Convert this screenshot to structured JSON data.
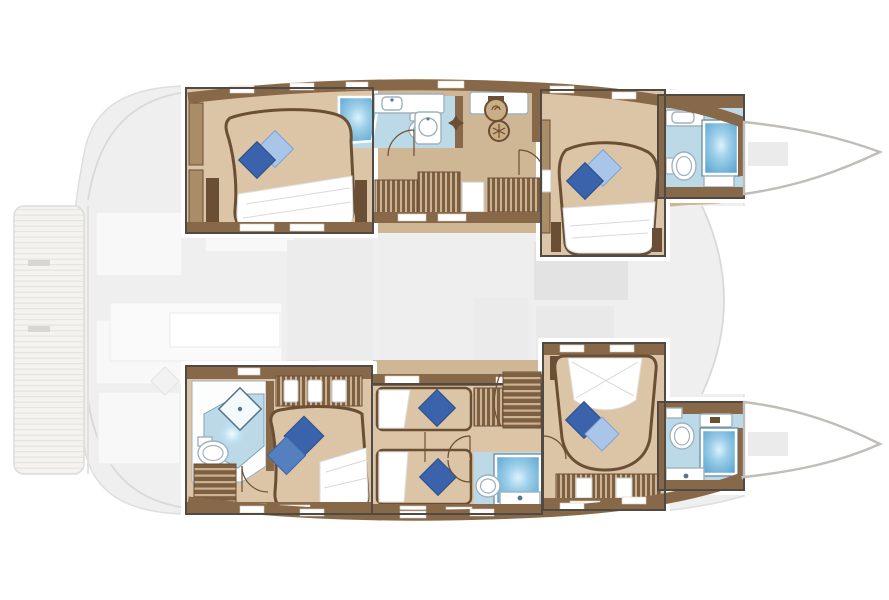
{
  "meta": {
    "aria_label": "Catamaran lower-deck floor plan, bow pointing right",
    "vessel_type": "catamaran",
    "view": "overhead deck / cabin layout plan",
    "bow_direction": "right"
  },
  "palette": {
    "bg": "#ffffff",
    "wood": "#876849",
    "wood_deep": "#6b4f35",
    "wood_mid": "#a98c68",
    "wood_light": "#cbb293",
    "floor": "#cfb694",
    "floor_cabin": "#dbc5a6",
    "bath": "#bcd9e8",
    "shower_deep": "#5da7d2",
    "shower_glow": "#e8f7fe",
    "pillow_navy": "#3a63ac",
    "pillow_blue": "#5580c0",
    "pillow_sky": "#a9c6e8",
    "fixture_stroke": "#9fb2bd",
    "box_border": "#4f4a44",
    "ghost": "#efefef",
    "ghost_2": "#e3e3e3",
    "ghost_stroke": "#d9d9d9",
    "hull_stroke": "#c0bdb8",
    "linen": "#ffffff"
  },
  "layout_counts": {
    "hulls": 2,
    "highlighted_cabin_modules": 6,
    "double_beds": 4,
    "single_beds": 2,
    "bathrooms": 5,
    "showers": 5,
    "stair_flights": 3
  },
  "modules": [
    {
      "id": "aft-port-cabin",
      "features": [
        "double-bed",
        "navy-pillow",
        "sky-pillow",
        "wardrobe",
        "ensuite-shower",
        "toilet",
        "sink"
      ]
    },
    {
      "id": "port-galley-corridor",
      "features": [
        "sink",
        "cooktop-rings",
        "stairs",
        "wardrobes",
        "hull-windows"
      ]
    },
    {
      "id": "fwd-port-cabin",
      "features": [
        "double-bed",
        "navy-pillow",
        "sky-pillow",
        "porthole"
      ]
    },
    {
      "id": "fwd-port-bathroom",
      "features": [
        "shower",
        "toilet",
        "sink-counter"
      ]
    },
    {
      "id": "aft-starboard-cabin",
      "features": [
        "double-bed",
        "navy-pillow",
        "blue-pillow",
        "shower-tray",
        "toilet",
        "sink",
        "hanging-lockers",
        "stairs"
      ]
    },
    {
      "id": "mid-starboard-cabins",
      "features": [
        "single-bed",
        "single-bed",
        "navy-pillow",
        "navy-pillow",
        "stairs",
        "shower",
        "toilet",
        "wardrobe"
      ]
    },
    {
      "id": "fwd-starboard-cabin",
      "features": [
        "double-bed",
        "navy-pillow",
        "sky-pillow",
        "wardrobe"
      ]
    },
    {
      "id": "fwd-starboard-bathroom",
      "features": [
        "shower",
        "toilet",
        "sink-counter"
      ]
    },
    {
      "id": "stern-swim-platform",
      "features": [
        "teak-deck"
      ]
    },
    {
      "id": "main-deck-ghost",
      "features": [
        "saloon-furniture-outlines",
        "cockpit-seating-outlines",
        "foredeck-trampoline"
      ]
    }
  ]
}
